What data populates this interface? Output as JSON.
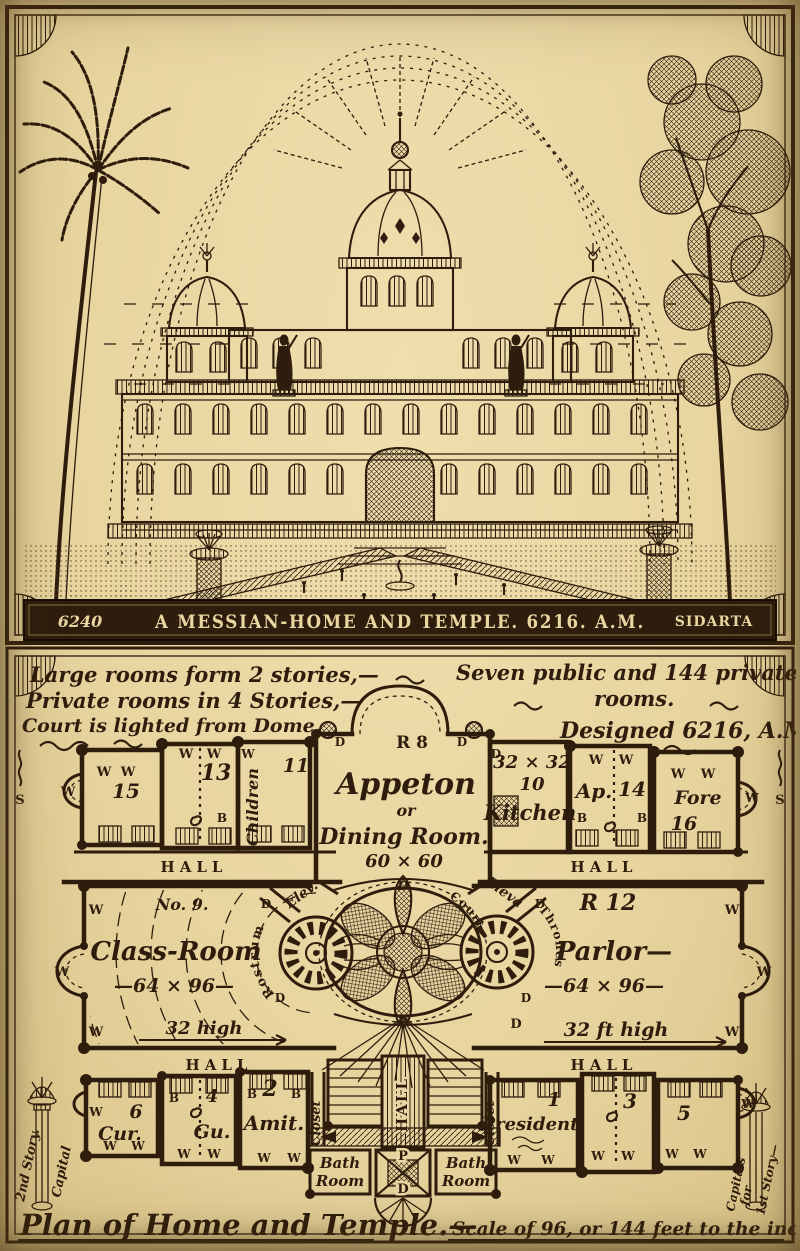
{
  "colors": {
    "paper": "#e8d5a0",
    "ink": "#2e1d0d"
  },
  "engraving": {
    "banner_left": "6240",
    "banner_title": "A MESSIAN-HOME AND TEMPLE. 6216. A.M.",
    "banner_right": "SIDARTA"
  },
  "plan": {
    "notes_left": [
      "Large rooms form 2 stories,—",
      "Private rooms in 4 Stories,—",
      "Court is lighted from Dome."
    ],
    "notes_right": [
      "Seven public and 144 private",
      "rooms.",
      "Designed 6216, A.M.—"
    ],
    "labels": {
      "window": "W",
      "bed": "B",
      "door": "D",
      "stairs": "S",
      "hall": "HALL",
      "closet": "Closet"
    },
    "rooms": {
      "appeton": {
        "id": "R 8",
        "name": "Appeton",
        "conj": "or",
        "alt": "Dining Room.",
        "size": "60 × 60"
      },
      "kitchen": {
        "size": "32 × 32",
        "num": "10",
        "name": "Kitchen"
      },
      "ap14": {
        "name": "Ap.",
        "num": "14"
      },
      "fore": {
        "name": "Fore",
        "num": "16"
      },
      "r15": "15",
      "r13": "13",
      "r11": "11",
      "children": "Children",
      "classroom": {
        "no": "No. 9.",
        "name": "Class-Room",
        "size": "—64 × 96—",
        "height": "32 high",
        "stage": "Rostrum"
      },
      "parlor": {
        "id": "R 12",
        "name": "Parlor—",
        "size": "—64 × 96—",
        "height": "32 ft high",
        "stage": "Thrones"
      },
      "court": {
        "name": "Court",
        "elev_left": "Elev.",
        "elev_right": "Eleva"
      },
      "cur": {
        "num": "6",
        "name": "Cur."
      },
      "gu": {
        "num": "4",
        "name": "Gu."
      },
      "amit": {
        "num": "2",
        "name": "Amit."
      },
      "president": {
        "num": "1",
        "name": "President"
      },
      "r3": "3",
      "r5": "5",
      "bath": {
        "line1": "Bath",
        "line2": "Room"
      },
      "pd": {
        "top": "P",
        "bottom": "D"
      }
    },
    "caption_left": "Plan of Home and Temple.—",
    "caption_right": "Scale of 96, or 144 feet to the inch",
    "margin_left": {
      "line1": "2nd Story.",
      "line2": "Capital"
    },
    "margin_right": {
      "line1": "Capitals",
      "line2": "for",
      "line3": "1st Story—"
    }
  }
}
